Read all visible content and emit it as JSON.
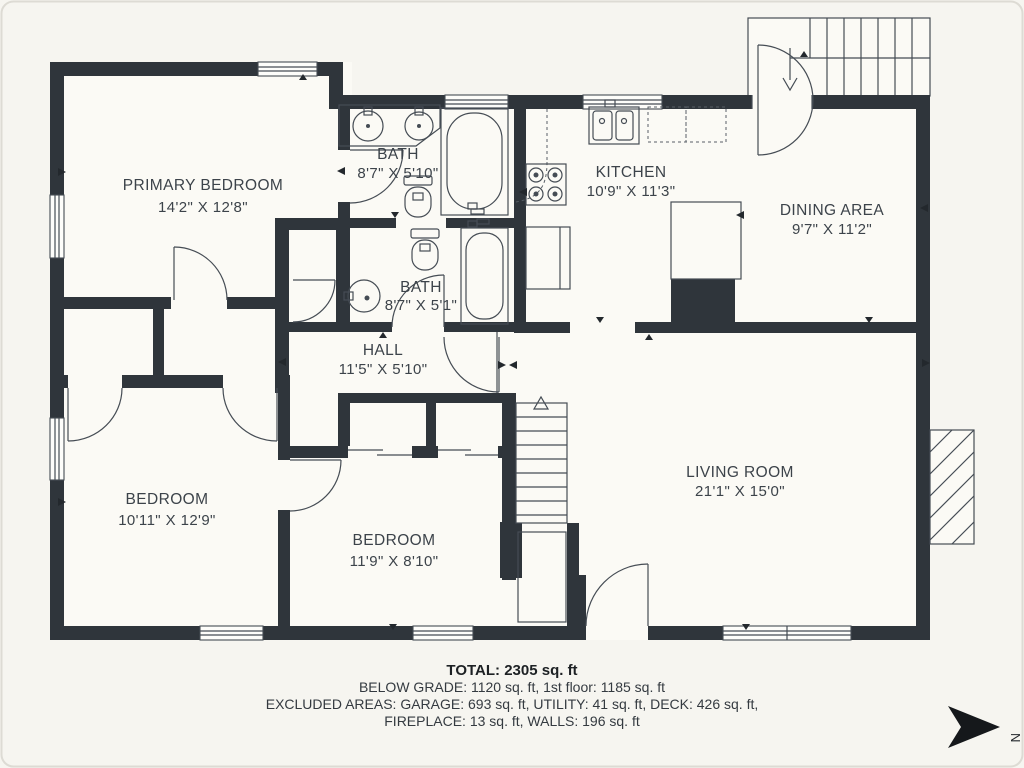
{
  "rooms": [
    {
      "id": "primary-bedroom",
      "name": "PRIMARY BEDROOM",
      "dims": "14'2\" X 12'8\""
    },
    {
      "id": "bath-1",
      "name": "BATH",
      "dims": "8'7\" X 5'10\""
    },
    {
      "id": "kitchen",
      "name": "KITCHEN",
      "dims": "10'9\" X 11'3\""
    },
    {
      "id": "dining-area",
      "name": "DINING AREA",
      "dims": "9'7\" X 11'2\""
    },
    {
      "id": "bath-2",
      "name": "BATH",
      "dims": "8'7\" X 5'1\""
    },
    {
      "id": "hall",
      "name": "HALL",
      "dims": "11'5\" X 5'10\""
    },
    {
      "id": "bedroom-left",
      "name": "BEDROOM",
      "dims": "10'11\" X 12'9\""
    },
    {
      "id": "bedroom-middle",
      "name": "BEDROOM",
      "dims": "11'9\" X 8'10\""
    },
    {
      "id": "living-room",
      "name": "LIVING ROOM",
      "dims": "21'1\" X 15'0\""
    }
  ],
  "footer": {
    "total": "TOTAL: 2305 sq. ft",
    "line1": "BELOW GRADE: 1120 sq. ft, 1st floor: 1185 sq. ft",
    "line2": "EXCLUDED AREAS: GARAGE: 693 sq. ft, UTILITY: 41 sq. ft, DECK: 426 sq. ft,",
    "line3": "FIREPLACE: 13 sq. ft, WALLS: 196 sq. ft"
  },
  "compass": {
    "direction_label": "N"
  },
  "colors": {
    "wall": "#2f353b",
    "background": "#f6f5f0",
    "room_fill": "#fbfaf5",
    "line": "#454c54",
    "text": "#3c434a"
  }
}
